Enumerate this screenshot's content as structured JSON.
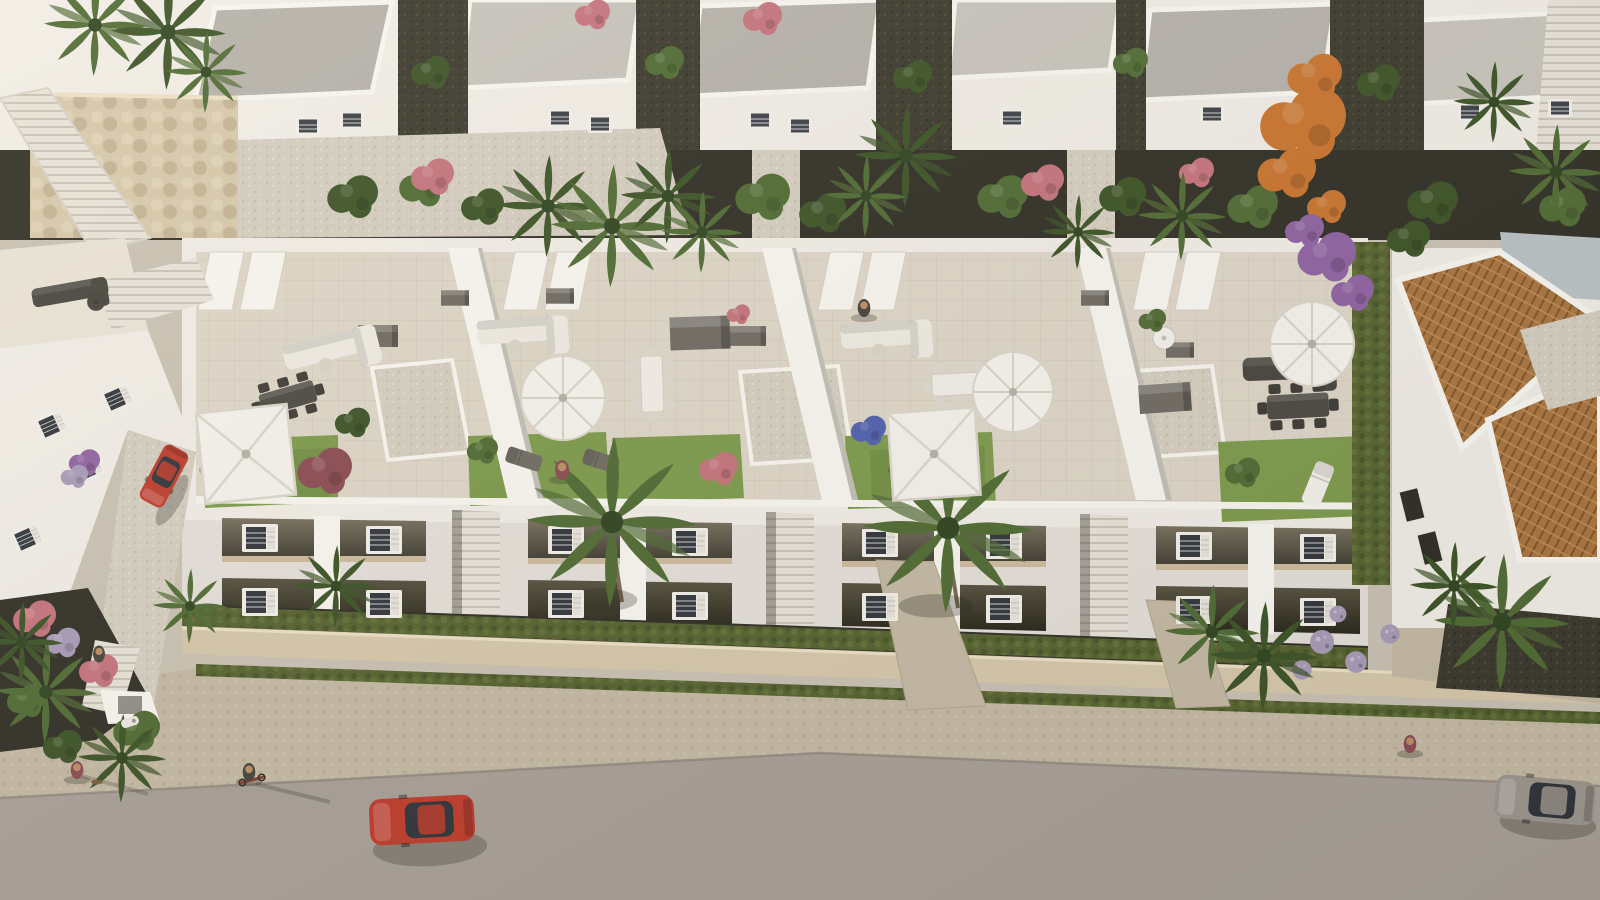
{
  "palette": {
    "paving": "#c9c2b4",
    "road": "#a8a098",
    "roadEdge": "#8a8279",
    "sidewalk": "#c4b9a4",
    "stoneWall": "#d6c8ab",
    "white": "#f1eee8",
    "whiteBright": "#f9f7f2",
    "whiteShade": "#d8d2c8",
    "roofGray": "#b5b2ac",
    "roofGrayLight": "#c7c4be",
    "roofGrayDark": "#9b9892",
    "terrace": "#ded7c9",
    "terraceLight": "#e9e3d7",
    "gravelDark": "#3a382d",
    "bedDark": "#2f2e25",
    "lawn": "#7c9a4c",
    "lawnDark": "#66833c",
    "hedge": "#55612f",
    "hedgeDark": "#47542a",
    "leaf": "#4e6a33",
    "leafDark": "#3b5226",
    "pink": "#c4737d",
    "purple": "#8e62a2",
    "lavender": "#a79ab8",
    "blue": "#4f5fae",
    "orange": "#c9742e",
    "maroon": "#8a4a52",
    "furnGray": "#6f6b63",
    "furnDark": "#44423c",
    "furnWhite": "#f4f2ec",
    "carRed": "#bf3a2b",
    "carSilver": "#9b968e",
    "terracotta": "#a8743f",
    "glass": "#2f333a",
    "stairTan": "#d9cdb6",
    "skin": "#b98e66"
  },
  "scene": {
    "items": [
      [
        "shad",
        232,
        470,
        1.5
      ],
      [
        "shad",
        920,
        470,
        1.45
      ],
      [
        "shad",
        550,
        412,
        1.2
      ],
      [
        "shad",
        1000,
        406,
        1.1
      ],
      [
        "shad",
        1300,
        358,
        1.1
      ],
      [
        "shad",
        600,
        600,
        1.7
      ],
      [
        "shad",
        936,
        606,
        1.7
      ],
      [
        "shad",
        430,
        848,
        2.6,
        -3
      ],
      [
        "shad",
        1548,
        824,
        2.2,
        4
      ],
      [
        "shad",
        172,
        500,
        1.3,
        -60
      ],
      [
        "shad",
        562,
        480,
        0.6
      ],
      [
        "shad",
        864,
        318,
        0.6
      ],
      [
        "shad",
        99,
        664,
        0.6
      ],
      [
        "shad",
        77,
        780,
        0.6
      ],
      [
        "shad",
        249,
        782,
        0.6
      ],
      [
        "shad",
        1410,
        754,
        0.6
      ],
      [
        "box",
        378,
        336,
        1.0
      ],
      [
        "box",
        560,
        296,
        0.7
      ],
      [
        "box",
        748,
        336,
        0.9
      ],
      [
        "box",
        1165,
        398,
        1.3,
        -4
      ],
      [
        "box",
        1180,
        350,
        0.7
      ],
      [
        "box",
        700,
        333,
        1.5,
        -2
      ],
      [
        "box",
        455,
        298,
        0.7
      ],
      [
        "box",
        1095,
        298,
        0.7
      ],
      [
        "sofaW",
        330,
        347,
        1.05,
        -14
      ],
      [
        "sofaW",
        522,
        330,
        1.0,
        -4
      ],
      [
        "sofaW",
        886,
        334,
        1.0,
        -4
      ],
      [
        "sofaD",
        1290,
        368,
        1.05,
        -2
      ],
      [
        "sofaD",
        70,
        292,
        0.85,
        -10
      ],
      [
        "dinD",
        288,
        398,
        1.0,
        -16
      ],
      [
        "dinD",
        1014,
        398,
        0.95,
        -4
      ],
      [
        "dinD",
        1298,
        406,
        1.1,
        -3
      ],
      [
        "dinW",
        652,
        384,
        1.0,
        88
      ],
      [
        "dinW",
        960,
        384,
        1.0,
        -3
      ],
      [
        "tableR",
        1164,
        338,
        1.0,
        0,
        "furnWhite"
      ],
      [
        "tableR",
        96,
        302,
        0.8,
        0,
        "furnDark"
      ],
      [
        "lounger",
        524,
        459,
        0.9,
        -72,
        "furnGray"
      ],
      [
        "lounger",
        601,
        461,
        0.9,
        -72,
        "furnGray"
      ],
      [
        "lounger",
        1318,
        484,
        1.1,
        22,
        "furnWhite"
      ],
      [
        "win",
        260,
        538
      ],
      [
        "win",
        384,
        540
      ],
      [
        "win",
        260,
        602
      ],
      [
        "win",
        384,
        604
      ],
      [
        "win",
        566,
        540
      ],
      [
        "win",
        690,
        542
      ],
      [
        "win",
        566,
        604
      ],
      [
        "win",
        690,
        606
      ],
      [
        "win",
        880,
        543
      ],
      [
        "win",
        1004,
        545
      ],
      [
        "win",
        880,
        607
      ],
      [
        "win",
        1004,
        609
      ],
      [
        "win",
        1194,
        546
      ],
      [
        "win",
        1318,
        548
      ],
      [
        "win",
        1194,
        610
      ],
      [
        "win",
        1318,
        612
      ],
      [
        "win",
        52,
        425,
        0.8,
        -24
      ],
      [
        "win",
        88,
        468,
        0.8,
        -24
      ],
      [
        "win",
        28,
        538,
        0.8,
        -24
      ],
      [
        "win",
        118,
        398,
        0.8,
        -24
      ],
      [
        "winS",
        308,
        126
      ],
      [
        "winS",
        352,
        120
      ],
      [
        "winS",
        560,
        118
      ],
      [
        "winS",
        600,
        124
      ],
      [
        "winS",
        760,
        120
      ],
      [
        "winS",
        800,
        126
      ],
      [
        "winS",
        1012,
        118
      ],
      [
        "winS",
        1212,
        114
      ],
      [
        "winS",
        1470,
        112
      ],
      [
        "winS",
        1560,
        108
      ],
      [
        "winD",
        1412,
        505,
        1,
        -14
      ],
      [
        "winD",
        1430,
        548,
        1,
        -14
      ],
      [
        "bush",
        352,
        196,
        1.3,
        0,
        "leafDark"
      ],
      [
        "bush",
        422,
        186,
        1.2,
        0,
        "leaf"
      ],
      [
        "bush",
        482,
        206,
        1.1,
        0,
        "leafDark"
      ],
      [
        "bush",
        762,
        196,
        1.4,
        0,
        "leaf"
      ],
      [
        "bush",
        822,
        212,
        1.2,
        0,
        "leafDark"
      ],
      [
        "bush",
        1002,
        196,
        1.3,
        0,
        "leaf"
      ],
      [
        "bush",
        1122,
        196,
        1.2,
        0,
        "leafDark"
      ],
      [
        "bush",
        1252,
        206,
        1.3,
        0,
        "leaf"
      ],
      [
        "bush",
        1432,
        202,
        1.3,
        0,
        "leafDark"
      ],
      [
        "bush",
        1562,
        206,
        1.2,
        0,
        "leaf"
      ],
      [
        "bush",
        430,
        72,
        1.0,
        0,
        "leafDark"
      ],
      [
        "bush",
        664,
        62,
        1.0,
        0,
        "leaf"
      ],
      [
        "bush",
        912,
        76,
        1.0,
        0,
        "leafDark"
      ],
      [
        "bush",
        1130,
        62,
        0.9,
        0,
        "leaf"
      ],
      [
        "bush",
        1378,
        82,
        1.1,
        0,
        "leafDark"
      ],
      [
        "bush",
        432,
        176,
        1.1,
        0,
        "pink"
      ],
      [
        "bush",
        1042,
        182,
        1.1,
        0,
        "pink"
      ],
      [
        "bush",
        762,
        18,
        1.0,
        0,
        "pink"
      ],
      [
        "bush",
        1196,
        172,
        0.9,
        0,
        "pink"
      ],
      [
        "bush",
        592,
        14,
        0.9,
        0,
        "pink"
      ],
      [
        "bush",
        1302,
        122,
        2.2,
        0,
        "orange"
      ],
      [
        "bush",
        1286,
        172,
        1.5,
        0,
        "orange"
      ],
      [
        "bush",
        1314,
        76,
        1.4,
        0,
        "orange"
      ],
      [
        "bush",
        1326,
        206,
        1.0,
        0,
        "orange"
      ],
      [
        "bush",
        1326,
        256,
        1.5,
        0,
        "purple"
      ],
      [
        "bush",
        1352,
        292,
        1.1,
        0,
        "purple"
      ],
      [
        "bush",
        1304,
        230,
        1.0,
        0,
        "purple"
      ],
      [
        "bush",
        84,
        462,
        0.8,
        0,
        "purple"
      ],
      [
        "bush",
        74,
        476,
        0.7,
        0,
        "lavender"
      ],
      [
        "bush",
        324,
        470,
        1.4,
        0,
        "maroon"
      ],
      [
        "bush",
        718,
        468,
        1.0,
        0,
        "pink"
      ],
      [
        "bush",
        868,
        430,
        0.9,
        0,
        "blue"
      ],
      [
        "bush",
        482,
        450,
        0.8,
        0,
        "leaf"
      ],
      [
        "bush",
        1242,
        472,
        0.9,
        0,
        "leaf"
      ],
      [
        "bush",
        352,
        422,
        0.9,
        0,
        "leafDark"
      ],
      [
        "bush",
        1152,
        320,
        0.7,
        0,
        "leaf"
      ],
      [
        "bush",
        738,
        314,
        0.6,
        0,
        "pink"
      ],
      [
        "bush",
        34,
        618,
        1.1,
        0,
        "pink"
      ],
      [
        "bush",
        62,
        642,
        0.9,
        0,
        "lavender"
      ],
      [
        "bush",
        98,
        670,
        1.0,
        0,
        "pink"
      ],
      [
        "bush",
        136,
        730,
        1.2,
        0,
        "leaf"
      ],
      [
        "bush",
        62,
        746,
        1.0,
        0,
        "leafDark"
      ],
      [
        "bush",
        26,
        700,
        1.0,
        0,
        "leaf"
      ],
      [
        "bush",
        1408,
        238,
        1.1,
        0,
        "leafDark"
      ],
      [
        "lav",
        1322,
        642,
        1.0
      ],
      [
        "lav",
        1356,
        662,
        0.9
      ],
      [
        "lav",
        1390,
        634,
        0.8
      ],
      [
        "lav",
        1302,
        670,
        0.8
      ],
      [
        "lav",
        1338,
        614,
        0.7
      ],
      [
        "palm",
        95,
        25,
        1.5,
        0,
        "leaf"
      ],
      [
        "palm",
        168,
        32,
        1.7,
        0,
        "leafDark"
      ],
      [
        "palm",
        206,
        72,
        1.2,
        0,
        "leaf"
      ],
      [
        "palm",
        548,
        206,
        1.5,
        0,
        "leafDark"
      ],
      [
        "palm",
        612,
        226,
        1.8,
        0,
        "leaf"
      ],
      [
        "palm",
        668,
        196,
        1.4,
        0,
        "leafDark"
      ],
      [
        "palm",
        702,
        232,
        1.2,
        0,
        "leaf"
      ],
      [
        "palm",
        906,
        156,
        1.5,
        0,
        "leafDark"
      ],
      [
        "palm",
        866,
        196,
        1.2,
        0,
        "leaf"
      ],
      [
        "palm",
        1078,
        232,
        1.1,
        0,
        "leafDark"
      ],
      [
        "palm",
        1182,
        216,
        1.3,
        0,
        "leaf"
      ],
      [
        "palm",
        1494,
        102,
        1.2,
        0,
        "leafDark"
      ],
      [
        "palm",
        1556,
        172,
        1.4,
        0,
        "leaf"
      ],
      [
        "palm",
        612,
        522,
        2.5,
        0,
        "leaf"
      ],
      [
        "palm",
        948,
        528,
        2.5,
        0,
        "leaf"
      ],
      [
        "palm",
        336,
        586,
        1.2,
        0,
        "leafDark"
      ],
      [
        "palm",
        1212,
        632,
        1.4,
        0,
        "leaf"
      ],
      [
        "palm",
        1264,
        656,
        1.6,
        0,
        "leafDark"
      ],
      [
        "palm",
        1502,
        622,
        2.0,
        0,
        "leaf"
      ],
      [
        "palm",
        1454,
        586,
        1.3,
        0,
        "leafDark"
      ],
      [
        "palm",
        46,
        692,
        1.5,
        0,
        "leaf"
      ],
      [
        "palm",
        22,
        642,
        1.2,
        0,
        "leafDark"
      ],
      [
        "palm",
        122,
        758,
        1.3,
        0,
        "leafDark"
      ],
      [
        "palm",
        190,
        606,
        1.1,
        0,
        "leaf"
      ],
      [
        "umbR",
        563,
        398,
        1.05
      ],
      [
        "umbR",
        1013,
        392,
        1.0
      ],
      [
        "umbR",
        1312,
        344,
        1.05
      ],
      [
        "umbS",
        246,
        454,
        1.3,
        -6
      ],
      [
        "umbS",
        934,
        454,
        1.25,
        -4
      ],
      [
        "scooter",
        130,
        722,
        1.0,
        -18
      ],
      [
        "bike",
        252,
        780,
        1.0,
        -15
      ],
      [
        "car",
        422,
        820,
        1.05,
        -3,
        "carRed"
      ],
      [
        "car",
        1545,
        800,
        1.0,
        5,
        "carSilver"
      ],
      [
        "car",
        164,
        476,
        0.62,
        -62,
        "carRed"
      ],
      [
        "person",
        562,
        470,
        1.0,
        0,
        "maroon"
      ],
      [
        "person",
        864,
        308,
        0.9,
        0,
        "furnDark"
      ],
      [
        "person",
        99,
        654,
        0.85,
        0,
        "furnDark"
      ],
      [
        "person",
        77,
        770,
        0.9,
        0,
        "maroon"
      ],
      [
        "person",
        249,
        772,
        0.9,
        0,
        "furnDark"
      ],
      [
        "person",
        1410,
        744,
        0.9,
        0,
        "maroon"
      ],
      [
        "dog",
        96,
        782,
        0.8
      ]
    ]
  }
}
